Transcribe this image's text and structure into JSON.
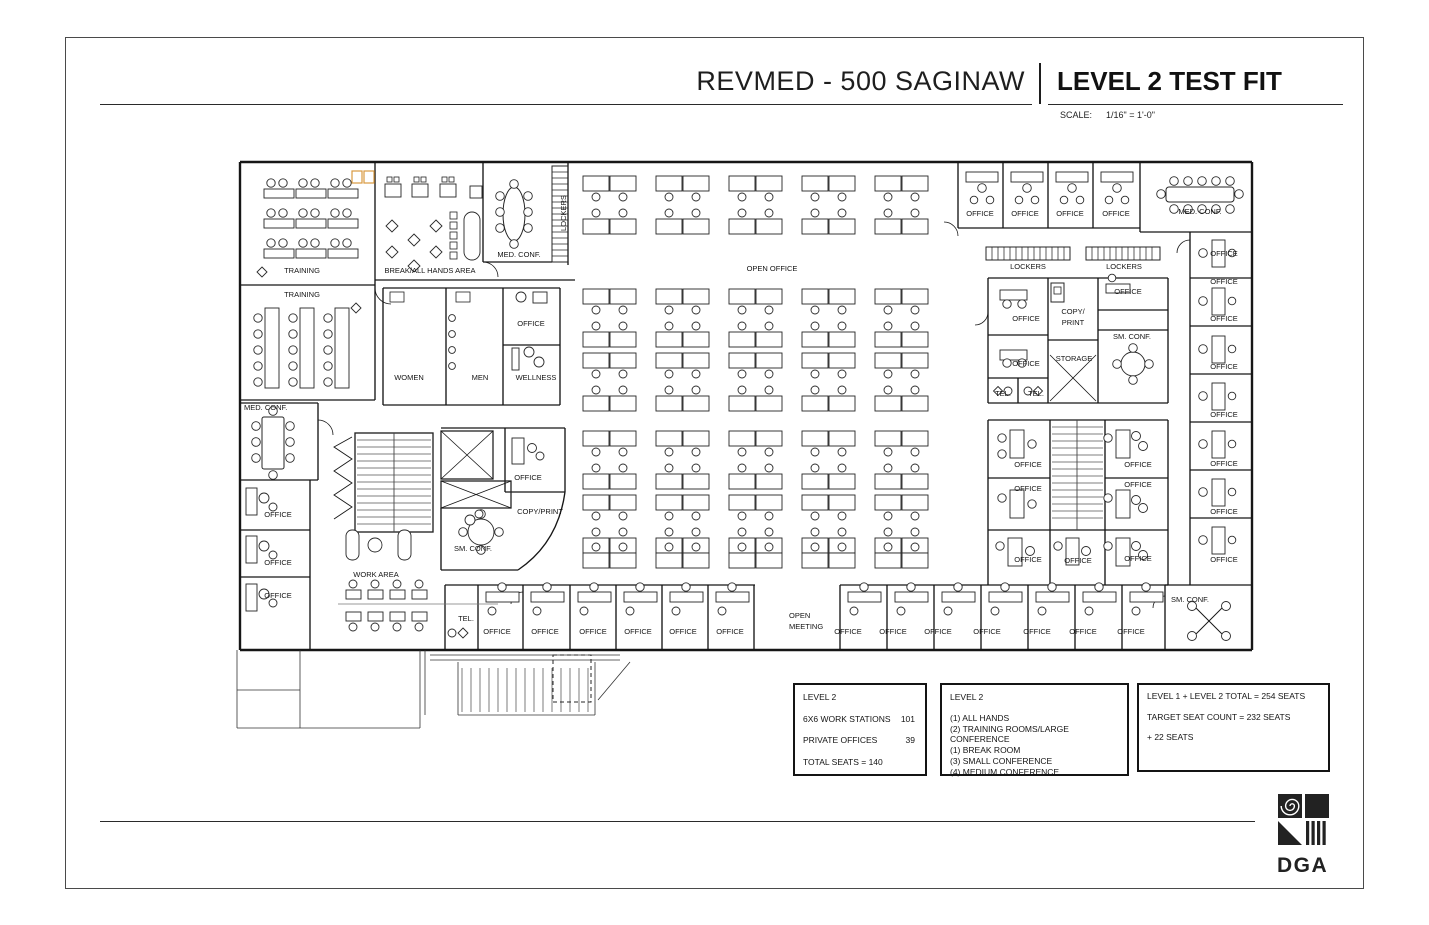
{
  "header": {
    "project_title": "REVMED - 500 SAGINAW",
    "sheet_title": "LEVEL 2 TEST FIT",
    "scale_label": "SCALE:",
    "scale_value": "1/16\" = 1'-0\""
  },
  "tables": [
    {
      "title": "LEVEL 2",
      "rows": [
        {
          "label": "6X6 WORK STATIONS",
          "value": "101"
        },
        {
          "label": "PRIVATE OFFICES",
          "value": "39"
        }
      ],
      "footer": "TOTAL SEATS = 140"
    },
    {
      "title": "LEVEL 2",
      "items": [
        "(1) ALL HANDS",
        "(2) TRAINING ROOMS/LARGE CONFERENCE",
        "(1) BREAK ROOM",
        "(3) SMALL CONFERENCE",
        "(4) MEDIUM CONFERENCE"
      ]
    },
    {
      "items": [
        "LEVEL 1 + LEVEL 2 TOTAL = 254 SEATS",
        "TARGET SEAT COUNT = 232 SEATS",
        "+ 22 SEATS"
      ]
    }
  ],
  "logo": {
    "text": "DGA"
  },
  "plan": {
    "labels": [
      {
        "t": "TRAINING",
        "x": 302,
        "y": 273
      },
      {
        "t": "TRAINING",
        "x": 302,
        "y": 297
      },
      {
        "t": "BREAK/ALL HANDS AREA",
        "x": 430,
        "y": 273
      },
      {
        "t": "MED. CONF.",
        "x": 519,
        "y": 257
      },
      {
        "t": "LOCKERS",
        "x": 566,
        "y": 213,
        "r": -90
      },
      {
        "t": "OPEN OFFICE",
        "x": 772,
        "y": 271
      },
      {
        "t": "OFFICE",
        "x": 980,
        "y": 216
      },
      {
        "t": "OFFICE",
        "x": 1025,
        "y": 216
      },
      {
        "t": "OFFICE",
        "x": 1070,
        "y": 216
      },
      {
        "t": "OFFICE",
        "x": 1116,
        "y": 216
      },
      {
        "t": "MED. CONF.",
        "x": 1200,
        "y": 214
      },
      {
        "t": "LOCKERS",
        "x": 1028,
        "y": 269
      },
      {
        "t": "LOCKERS",
        "x": 1124,
        "y": 269
      },
      {
        "t": "OFFICE",
        "x": 1026,
        "y": 321
      },
      {
        "t": "COPY/",
        "x": 1073,
        "y": 314
      },
      {
        "t": "PRINT",
        "x": 1073,
        "y": 325
      },
      {
        "t": "OFFICE",
        "x": 1128,
        "y": 294
      },
      {
        "t": "SM. CONF.",
        "x": 1132,
        "y": 339
      },
      {
        "t": "STORAGE",
        "x": 1074,
        "y": 361
      },
      {
        "t": "OFFICE",
        "x": 1026,
        "y": 366
      },
      {
        "t": "TEL.",
        "x": 1003,
        "y": 396
      },
      {
        "t": "TEL.",
        "x": 1036,
        "y": 396
      },
      {
        "t": "OFFICE",
        "x": 1224,
        "y": 256
      },
      {
        "t": "OFFICE",
        "x": 1224,
        "y": 284
      },
      {
        "t": "OFFICE",
        "x": 1224,
        "y": 321
      },
      {
        "t": "OFFICE",
        "x": 1224,
        "y": 369
      },
      {
        "t": "OFFICE",
        "x": 1224,
        "y": 417
      },
      {
        "t": "OFFICE",
        "x": 1224,
        "y": 466
      },
      {
        "t": "OFFICE",
        "x": 1224,
        "y": 514
      },
      {
        "t": "OFFICE",
        "x": 1224,
        "y": 562
      },
      {
        "t": "MED. CONF.",
        "x": 244,
        "y": 410,
        "a": "s"
      },
      {
        "t": "OFFICE",
        "x": 278,
        "y": 517
      },
      {
        "t": "OFFICE",
        "x": 278,
        "y": 565
      },
      {
        "t": "OFFICE",
        "x": 278,
        "y": 598
      },
      {
        "t": "WOMEN",
        "x": 409,
        "y": 380
      },
      {
        "t": "MEN",
        "x": 480,
        "y": 380
      },
      {
        "t": "WELLNESS",
        "x": 536,
        "y": 380
      },
      {
        "t": "OFFICE",
        "x": 531,
        "y": 326
      },
      {
        "t": "OFFICE",
        "x": 528,
        "y": 480
      },
      {
        "t": "COPY/PRINT",
        "x": 540,
        "y": 514
      },
      {
        "t": "SM. CONF.",
        "x": 473,
        "y": 551
      },
      {
        "t": "WORK AREA",
        "x": 376,
        "y": 577
      },
      {
        "t": "TEL.",
        "x": 466,
        "y": 621
      },
      {
        "t": "OFFICE",
        "x": 497,
        "y": 634
      },
      {
        "t": "OFFICE",
        "x": 545,
        "y": 634
      },
      {
        "t": "OFFICE",
        "x": 593,
        "y": 634
      },
      {
        "t": "OFFICE",
        "x": 638,
        "y": 634
      },
      {
        "t": "OFFICE",
        "x": 683,
        "y": 634
      },
      {
        "t": "OFFICE",
        "x": 730,
        "y": 634
      },
      {
        "t": "OPEN",
        "x": 789,
        "y": 618,
        "a": "s"
      },
      {
        "t": "MEETING",
        "x": 789,
        "y": 629,
        "a": "s"
      },
      {
        "t": "OFFICE",
        "x": 848,
        "y": 634
      },
      {
        "t": "OFFICE",
        "x": 893,
        "y": 634
      },
      {
        "t": "OFFICE",
        "x": 938,
        "y": 634
      },
      {
        "t": "OFFICE",
        "x": 987,
        "y": 634
      },
      {
        "t": "OFFICE",
        "x": 1037,
        "y": 634
      },
      {
        "t": "OFFICE",
        "x": 1083,
        "y": 634
      },
      {
        "t": "OFFICE",
        "x": 1131,
        "y": 634
      },
      {
        "t": "SM. CONF.",
        "x": 1190,
        "y": 602
      },
      {
        "t": "OFFICE",
        "x": 1028,
        "y": 467
      },
      {
        "t": "OFFICE",
        "x": 1028,
        "y": 491
      },
      {
        "t": "OFFICE",
        "x": 1138,
        "y": 467
      },
      {
        "t": "OFFICE",
        "x": 1138,
        "y": 487
      },
      {
        "t": "OFFICE",
        "x": 1028,
        "y": 562
      },
      {
        "t": "OFFICE",
        "x": 1078,
        "y": 563
      },
      {
        "t": "OFFICE",
        "x": 1138,
        "y": 561
      }
    ]
  }
}
